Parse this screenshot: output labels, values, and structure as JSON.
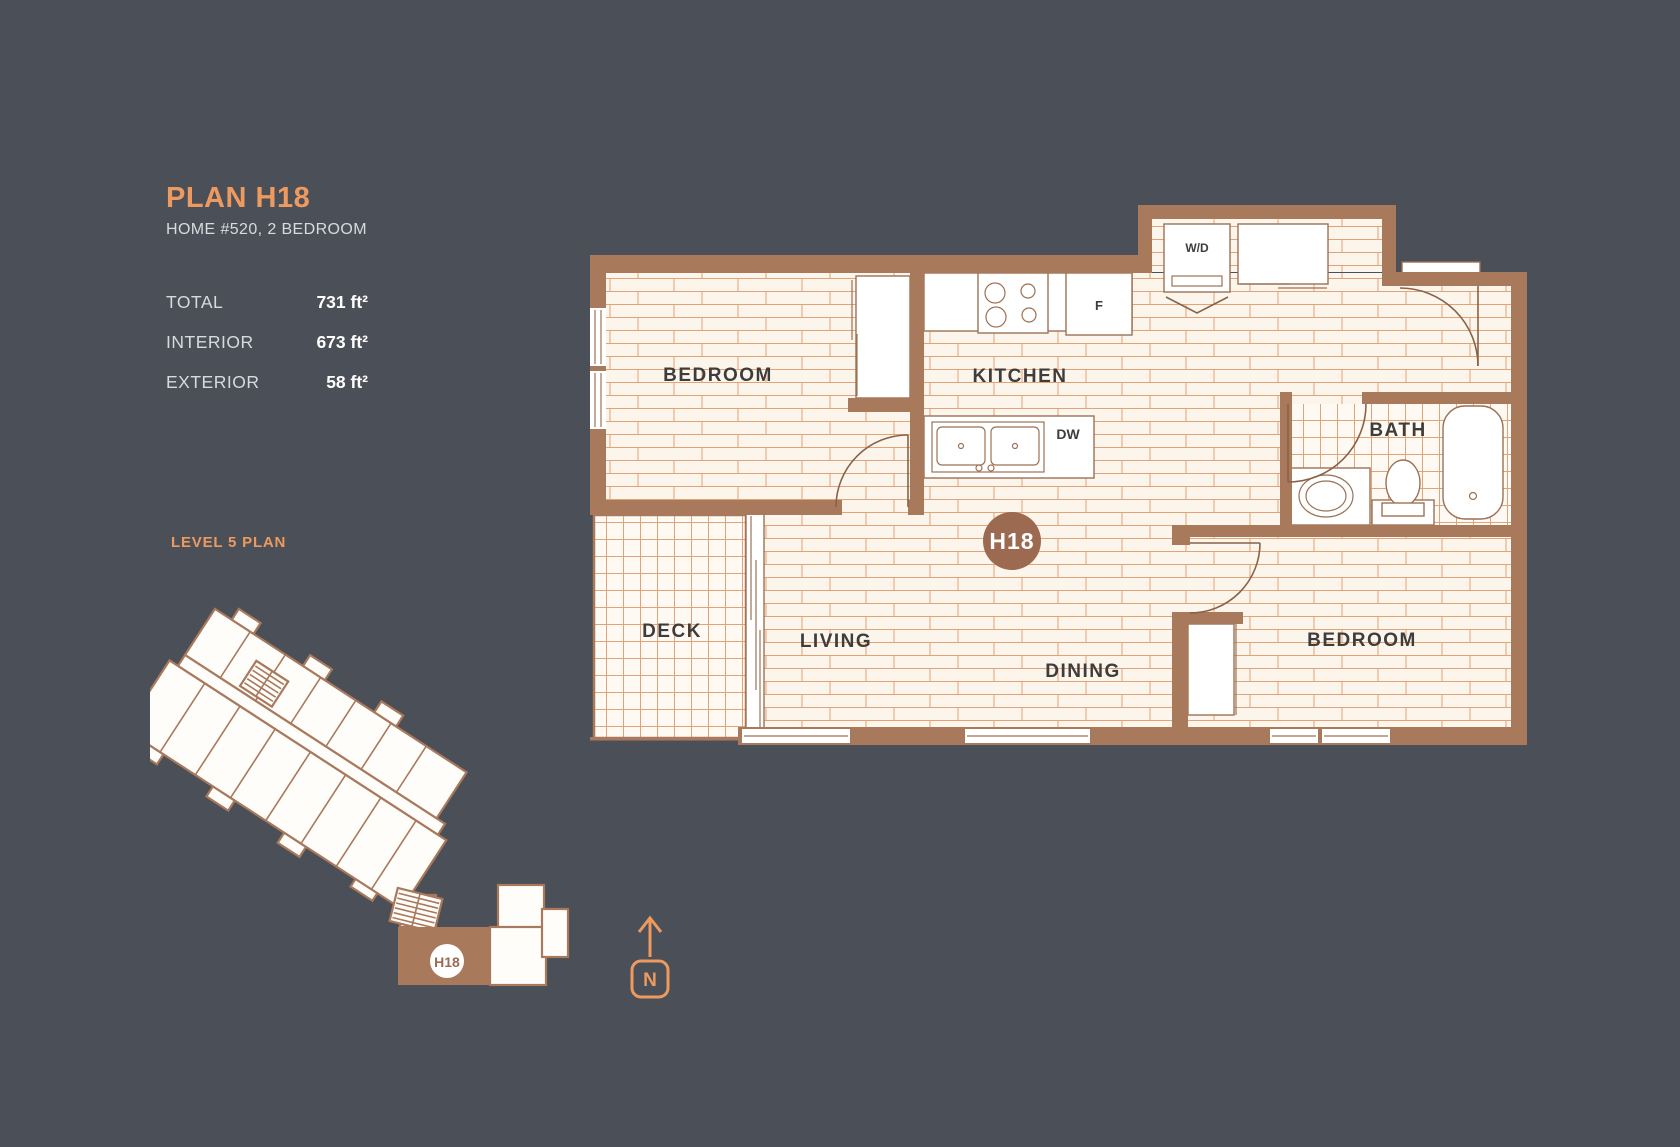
{
  "panel": {
    "title": "PLAN H18",
    "subtitle": "HOME #520, 2 BEDROOM",
    "stats": [
      {
        "label": "TOTAL",
        "value": "731 ft²"
      },
      {
        "label": "INTERIOR",
        "value": "673 ft²"
      },
      {
        "label": "EXTERIOR",
        "value": "58 ft²"
      }
    ],
    "level_label": "LEVEL 5 PLAN"
  },
  "floorplan": {
    "unit_badge": "H18",
    "rooms": {
      "bedroom1": "BEDROOM",
      "kitchen": "KITCHEN",
      "bath": "BATH",
      "deck": "DECK",
      "living": "LIVING",
      "dining": "DINING",
      "bedroom2": "BEDROOM"
    },
    "labels": {
      "washer_dryer": "W/D",
      "fridge": "F",
      "dishwasher": "DW"
    }
  },
  "mini_plan": {
    "unit_badge": "H18"
  },
  "compass": {
    "label": "N"
  },
  "colors": {
    "background": "#4b4f57",
    "wall_brown": "#a9795c",
    "accent_orange": "#ed9a60",
    "badge_brown": "#9c6a50",
    "floor_cream": "#fcf5ec",
    "floor_line_orange": "#e2a476",
    "label_dark": "#3f3d3c",
    "text_light": "#d8dadd",
    "value_white": "#ffffff"
  }
}
